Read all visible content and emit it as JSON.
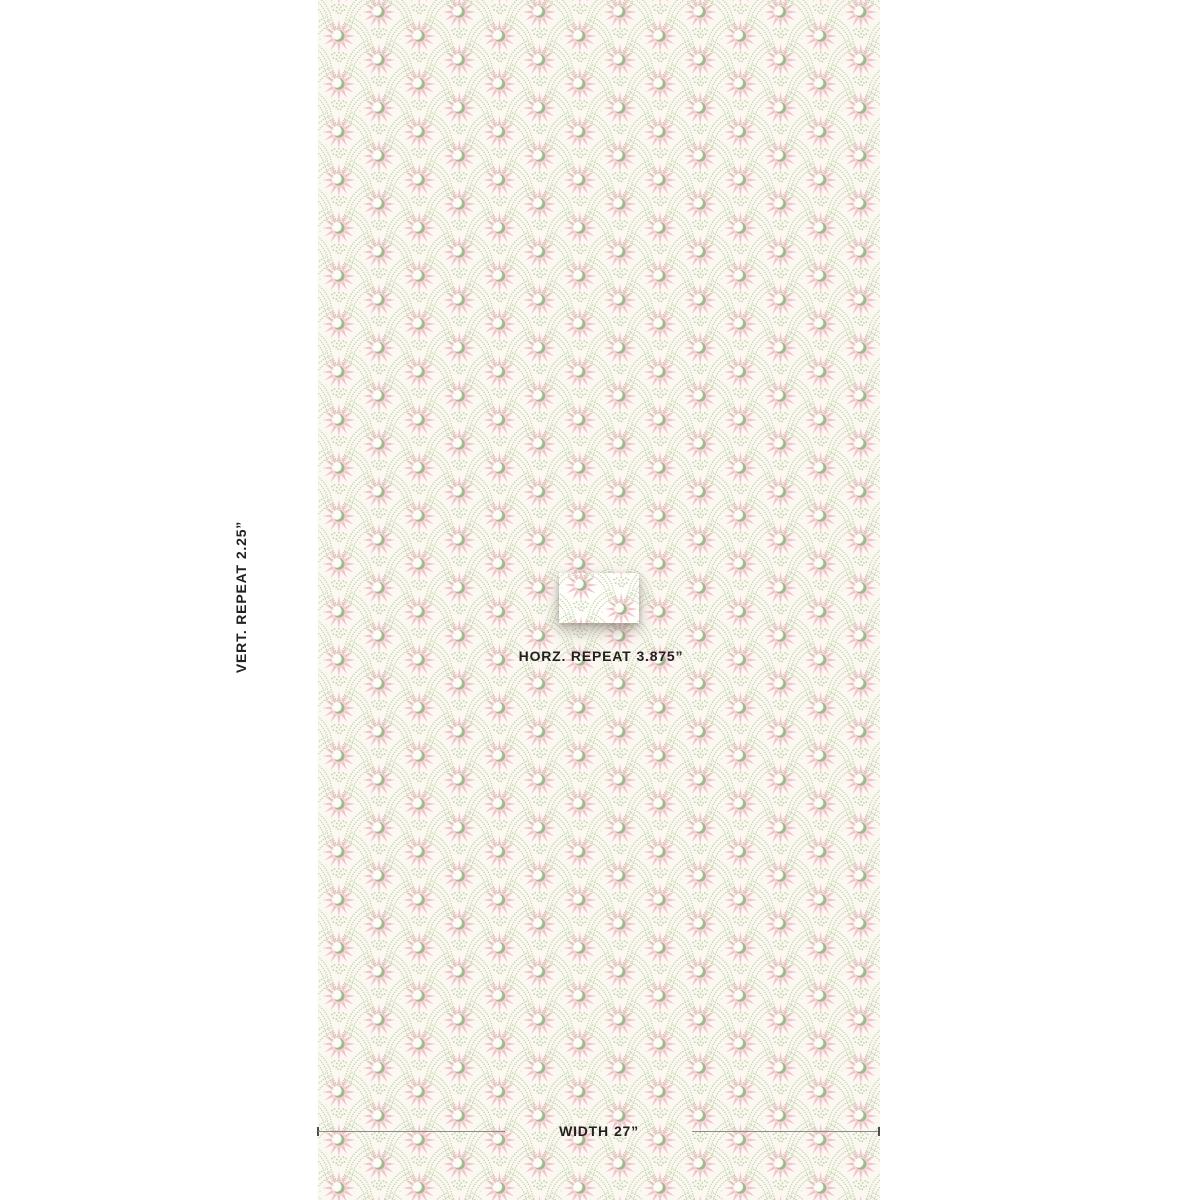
{
  "annotations": {
    "vertical_repeat": {
      "label": "VERT. REPEAT",
      "value": "2.25”"
    },
    "horizontal_repeat": {
      "label": "HORZ. REPEAT",
      "value": "3.875”"
    },
    "width": {
      "label": "WIDTH",
      "value": "27”"
    }
  },
  "pattern": {
    "motif": "pink sunburst star with green crescent moon",
    "trellis": "dotted ogee bands of tiny green dots"
  },
  "palette": {
    "page-bg": "#ffffff",
    "swatch-bg": "#fbf8f1",
    "card-bg": "#fffefa",
    "star-pink": "#f4c2cb",
    "star-core-pink": "#f8d4da",
    "moon-green": "#9dba8c",
    "dot-green": "#bdcfa6",
    "dot-pink": "#f6dade",
    "text": "#231f20",
    "measure-line": "#8d8d8d",
    "measure-tick": "#4d4d4d"
  }
}
